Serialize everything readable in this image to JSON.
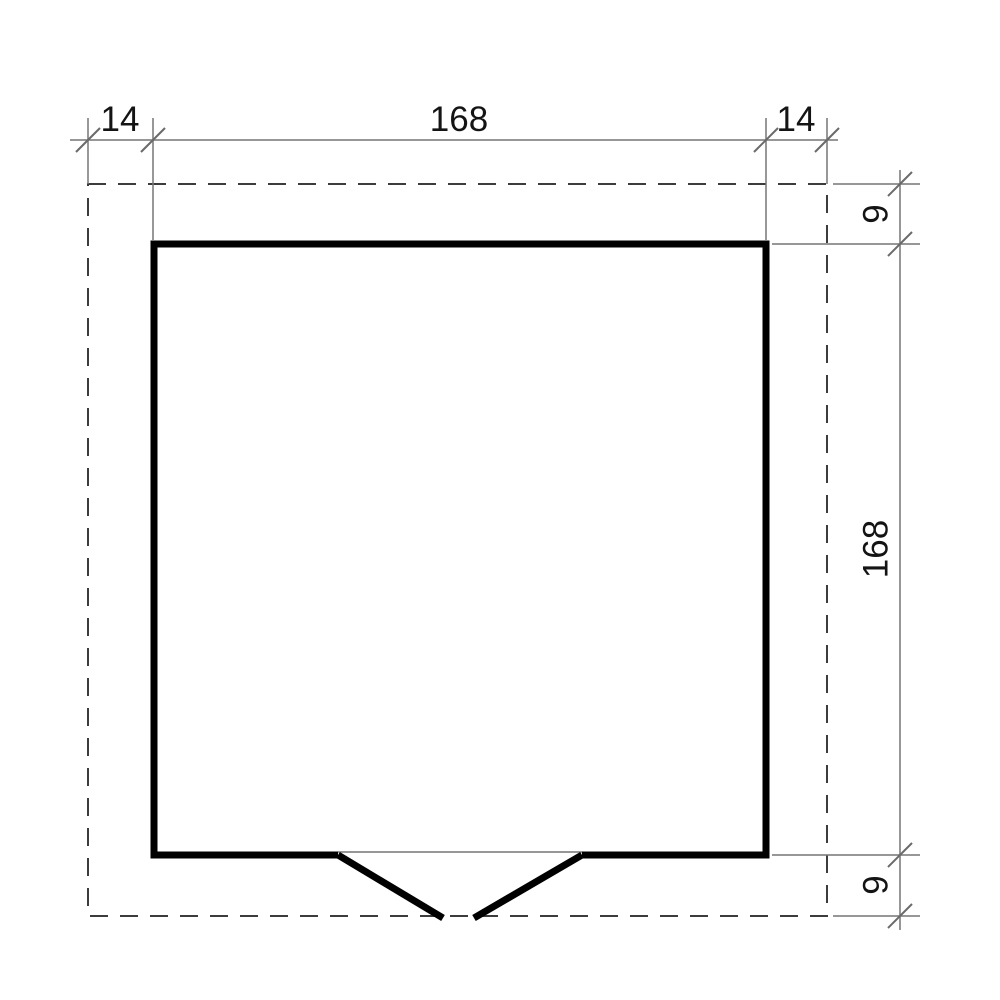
{
  "drawing": {
    "kind": "floor-plan-dimension-drawing",
    "dimensions": {
      "top": [
        {
          "label": "14",
          "value": 14
        },
        {
          "label": "168",
          "value": 168
        },
        {
          "label": "14",
          "value": 14
        }
      ],
      "right": [
        {
          "label": "9",
          "value": 9
        },
        {
          "label": "168",
          "value": 168
        },
        {
          "label": "9",
          "value": 9
        }
      ]
    },
    "colors": {
      "wall": "#000000",
      "dashed_outline": "#3c3c3c",
      "dimension_line": "#757575",
      "tick": "#6a6a6a",
      "text": "#141414"
    }
  }
}
